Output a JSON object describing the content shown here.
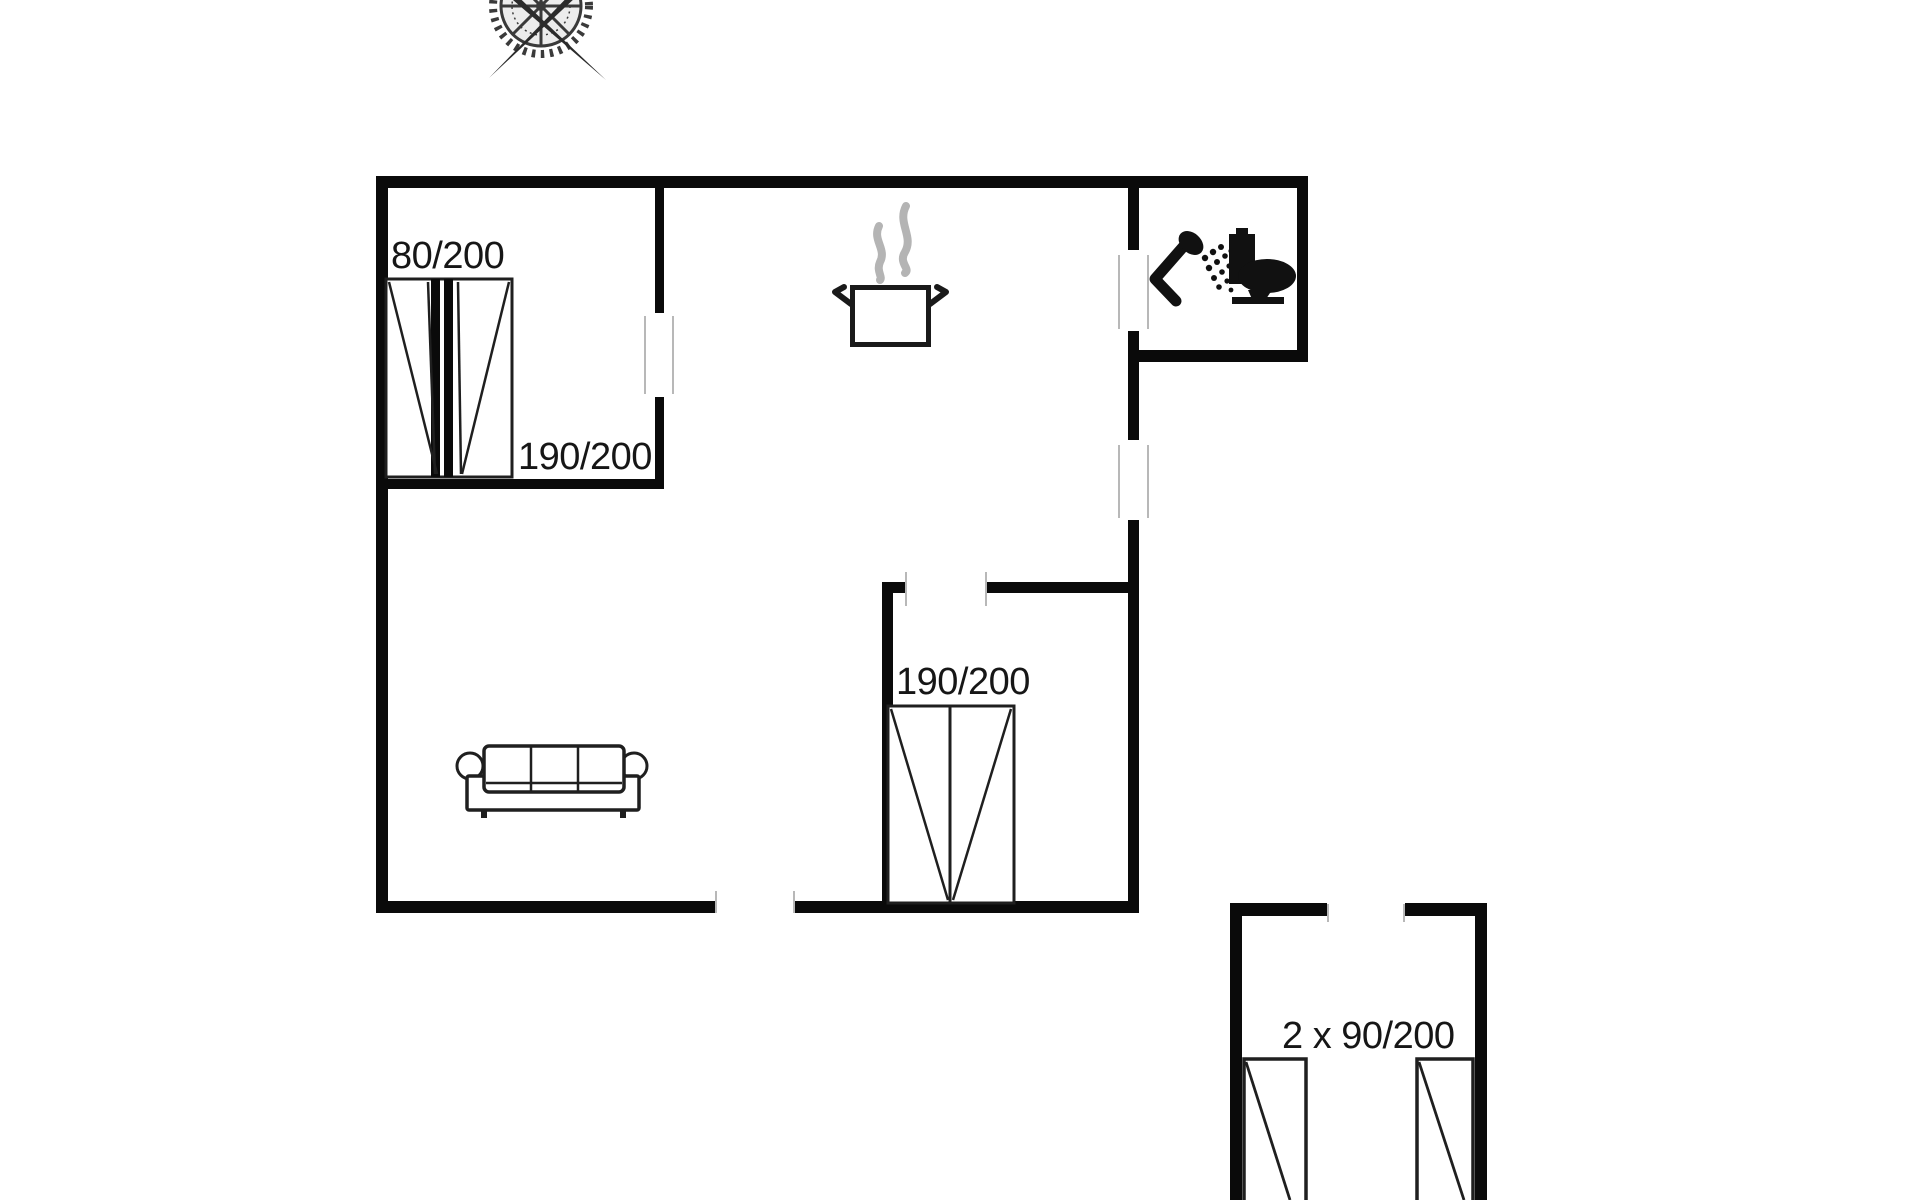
{
  "page": {
    "background": "#ffffff",
    "kind": "holiday-home floor plan drawing"
  },
  "floorplan": {
    "colors": {
      "background": "#ffffff",
      "wall": "#0a0a0a",
      "furniture_outline": "#1f1f1f",
      "steam": "#b4b4b4",
      "door_frame": "#b8b8b8",
      "label_text": "#161616",
      "compass": "#3a3a3a"
    },
    "labels": {
      "bedroom1_bed_single": "80/200",
      "bedroom1_bed_double": "190/200",
      "bedroom2_bed_double": "190/200",
      "annex_twin_beds": "2 x 90/200"
    },
    "icons": {
      "compass": "compass-rose-icon",
      "steam": "steam-icon",
      "pot": "cooking-pot-icon",
      "shower": "shower-icon",
      "toilet": "toilet-icon",
      "sofa": "sofa-icon",
      "bed_combo": "single-and-double-bed-icon",
      "bed_double": "double-bed-icon",
      "twin_beds": "twin-beds-icon"
    }
  }
}
